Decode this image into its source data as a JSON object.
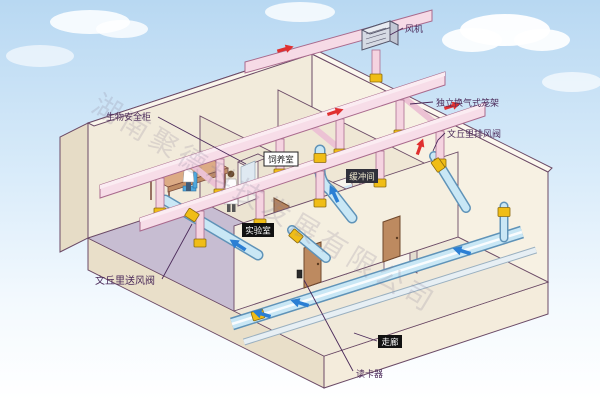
{
  "scene": {
    "subject": "Isometric cutaway illustration of a laboratory-animal facility ventilation (HVAC) system"
  },
  "labels": {
    "fan": "风机",
    "ivc_rack": "独立换气式笼架",
    "venturi_exhaust_valve": "文丘里排风阀",
    "biosafety_cabinet": "生物安全柜",
    "venturi_supply_valve": "文丘里送风阀",
    "card_reader": "读卡器"
  },
  "rooms": {
    "laboratory": "实验室",
    "rearing_room": "饲养室",
    "buffer_room": "缓冲间",
    "corridor": "走廊"
  },
  "watermark": "湖南聚德科技发展有限公司",
  "colors": {
    "sky_blue": "#b8d8f2",
    "wall_cream": "#f2ebdb",
    "floor_lavender": "#c7bdd2",
    "duct_pink": "#f6dae6",
    "duct_blue": "#c9e7f5",
    "valve_yellow": "#f0bd16",
    "door_brown": "#bd8a60",
    "label_purple": "#4b2a5a",
    "arrow_red": "#e03030",
    "arrow_blue": "#2b7fd4"
  }
}
